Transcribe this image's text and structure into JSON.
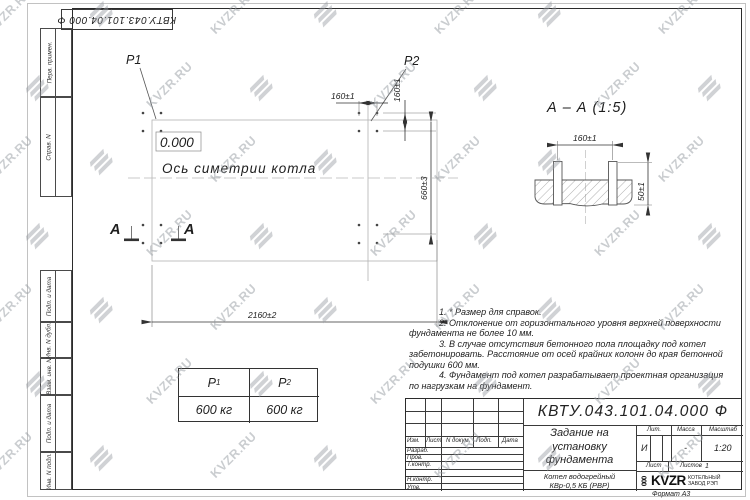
{
  "watermark": {
    "text": "KVZR.RU"
  },
  "top_stamp": {
    "text": "КВТУ.043.101.04.000  Ф"
  },
  "side_margin": {
    "top_cells": [
      "Перв. примен.",
      "Справ. N"
    ],
    "bottom_cells": [
      "Подп. и дата",
      "Инв. N дубл.",
      "Взам. инв. N",
      "Подп. и дата",
      "Инв. N подл."
    ]
  },
  "plan": {
    "p1": "P1",
    "p2": "P2",
    "level_mark": "0.000",
    "axis_label": "Ось симетрии котла",
    "dims": {
      "h160": "160±1",
      "v160": "160±1",
      "v660": "660±3",
      "h2160": "2160±2"
    },
    "section_letter_left": "А",
    "section_letter_right": "А"
  },
  "section_view": {
    "title": "А – А (1:5)",
    "dim_width": "160±1",
    "dim_height": "50±1"
  },
  "notes": {
    "lines": [
      "1. * Размер для справок.",
      "2. Отклонение от горизонтального уровня верхней поверхности",
      "фундамента не более 10 мм.",
      "3. В случае отсутствия бетонного пола площадку под котел",
      "забетонировать. Расстояние от осей крайних колонн до края бетонной",
      "подушки 600 мм.",
      "4. Фундамент под котел разрабатывает проектная организация",
      "по нагрузкам на фундамент."
    ]
  },
  "load_table": {
    "col1": {
      "symbol": "P",
      "sub": "1",
      "value": "600 кг"
    },
    "col2": {
      "symbol": "P",
      "sub": "2",
      "value": "600 кг"
    }
  },
  "title_block": {
    "doc_number": "КВТУ.043.101.04.000  Ф",
    "title_line1": "Задание на",
    "title_line2": "установку",
    "title_line3": "фундамента",
    "product_line1": "Котел водогрейный",
    "product_line2": "КВр-0,5 КБ (РВР)",
    "header_cols": {
      "izm": "Изм.",
      "list": "Лист",
      "doc": "N докум.",
      "podp": "Подп.",
      "data": "Дата"
    },
    "sign_rows": [
      "Разраб.",
      "Пров.",
      "Т.контр.",
      "",
      "Н.контр.",
      "Утв."
    ],
    "lit_label": "Лит.",
    "mass_label": "Масса",
    "scale_label": "Масштаб",
    "lit_value": "И",
    "mass_value": "-",
    "scale_value": "1:20",
    "sheet_label": "Лист",
    "sheets_label": "Листов",
    "sheets_value": "1",
    "logo": {
      "coil": "000",
      "name": "KVZR",
      "sub1": "КОТЕЛЬНЫЙ",
      "sub2": "ЗАВОД РЭП"
    }
  },
  "footer": {
    "format_label": "Формат А3"
  }
}
